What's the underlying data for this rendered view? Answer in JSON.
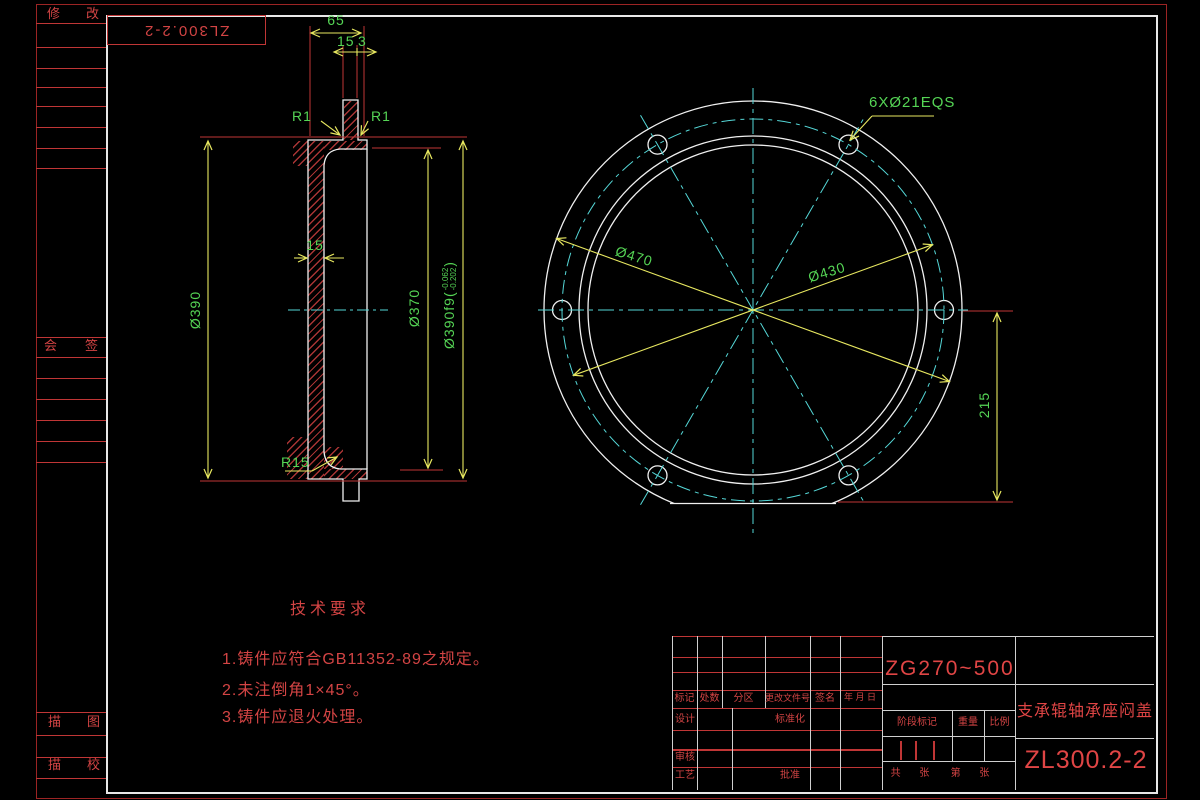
{
  "colors": {
    "background": "#000000",
    "geometry_white": "#f0f0f0",
    "dimension_green": "#55d555",
    "dimension_yellow": "#e8e860",
    "centerline_cyan": "#55d8d8",
    "annotation_red": "#c03636"
  },
  "sidebar": {
    "modify": "修改",
    "countersign": "会签",
    "trace": "描图",
    "trace_check": "描校"
  },
  "stamp": {
    "code": "ZL300.2-2"
  },
  "section": {
    "dim_total_depth": "65",
    "dim_flange_thk": "15",
    "dim_gap": "3",
    "fillet_left": "R1",
    "fillet_right": "R1",
    "dim_wall": "15",
    "dia_plate": "Ø390",
    "dia_inner": "Ø370",
    "dia_spigot_open": "Ø390f9(",
    "tol_upper": "-0.062",
    "tol_lower": "-0.202",
    "dia_spigot_close": ")",
    "fillet_bottom": "R15"
  },
  "front": {
    "holes_note": "6XØ21EQS",
    "dia_outer": "Ø470",
    "dia_bolt_circle": "Ø430",
    "dim_flat": "215"
  },
  "tech_req": {
    "title": "技术要求",
    "item1": "1.铸件应符合GB11352-89之规定。",
    "item2": "2.未注倒角1×45°。",
    "item3": "3.铸件应退火处理。"
  },
  "title_block": {
    "material": "ZG270~500",
    "part_name": "支承辊轴承座闷盖",
    "drawing_no": "ZL300.2-2",
    "col_mark": "标记",
    "col_count": "处数",
    "col_zone": "分区",
    "col_change_doc": "更改文件号",
    "col_sign": "签名",
    "col_date": "年 月 日",
    "row_design": "设计",
    "row_standard": "标准化",
    "row_audit": "审核",
    "row_process": "工艺",
    "row_approve": "批准",
    "stage_mark": "阶段标记",
    "weight": "重量",
    "scale": "比例",
    "sheets_total": "共  张",
    "sheet_no": "第  张"
  }
}
